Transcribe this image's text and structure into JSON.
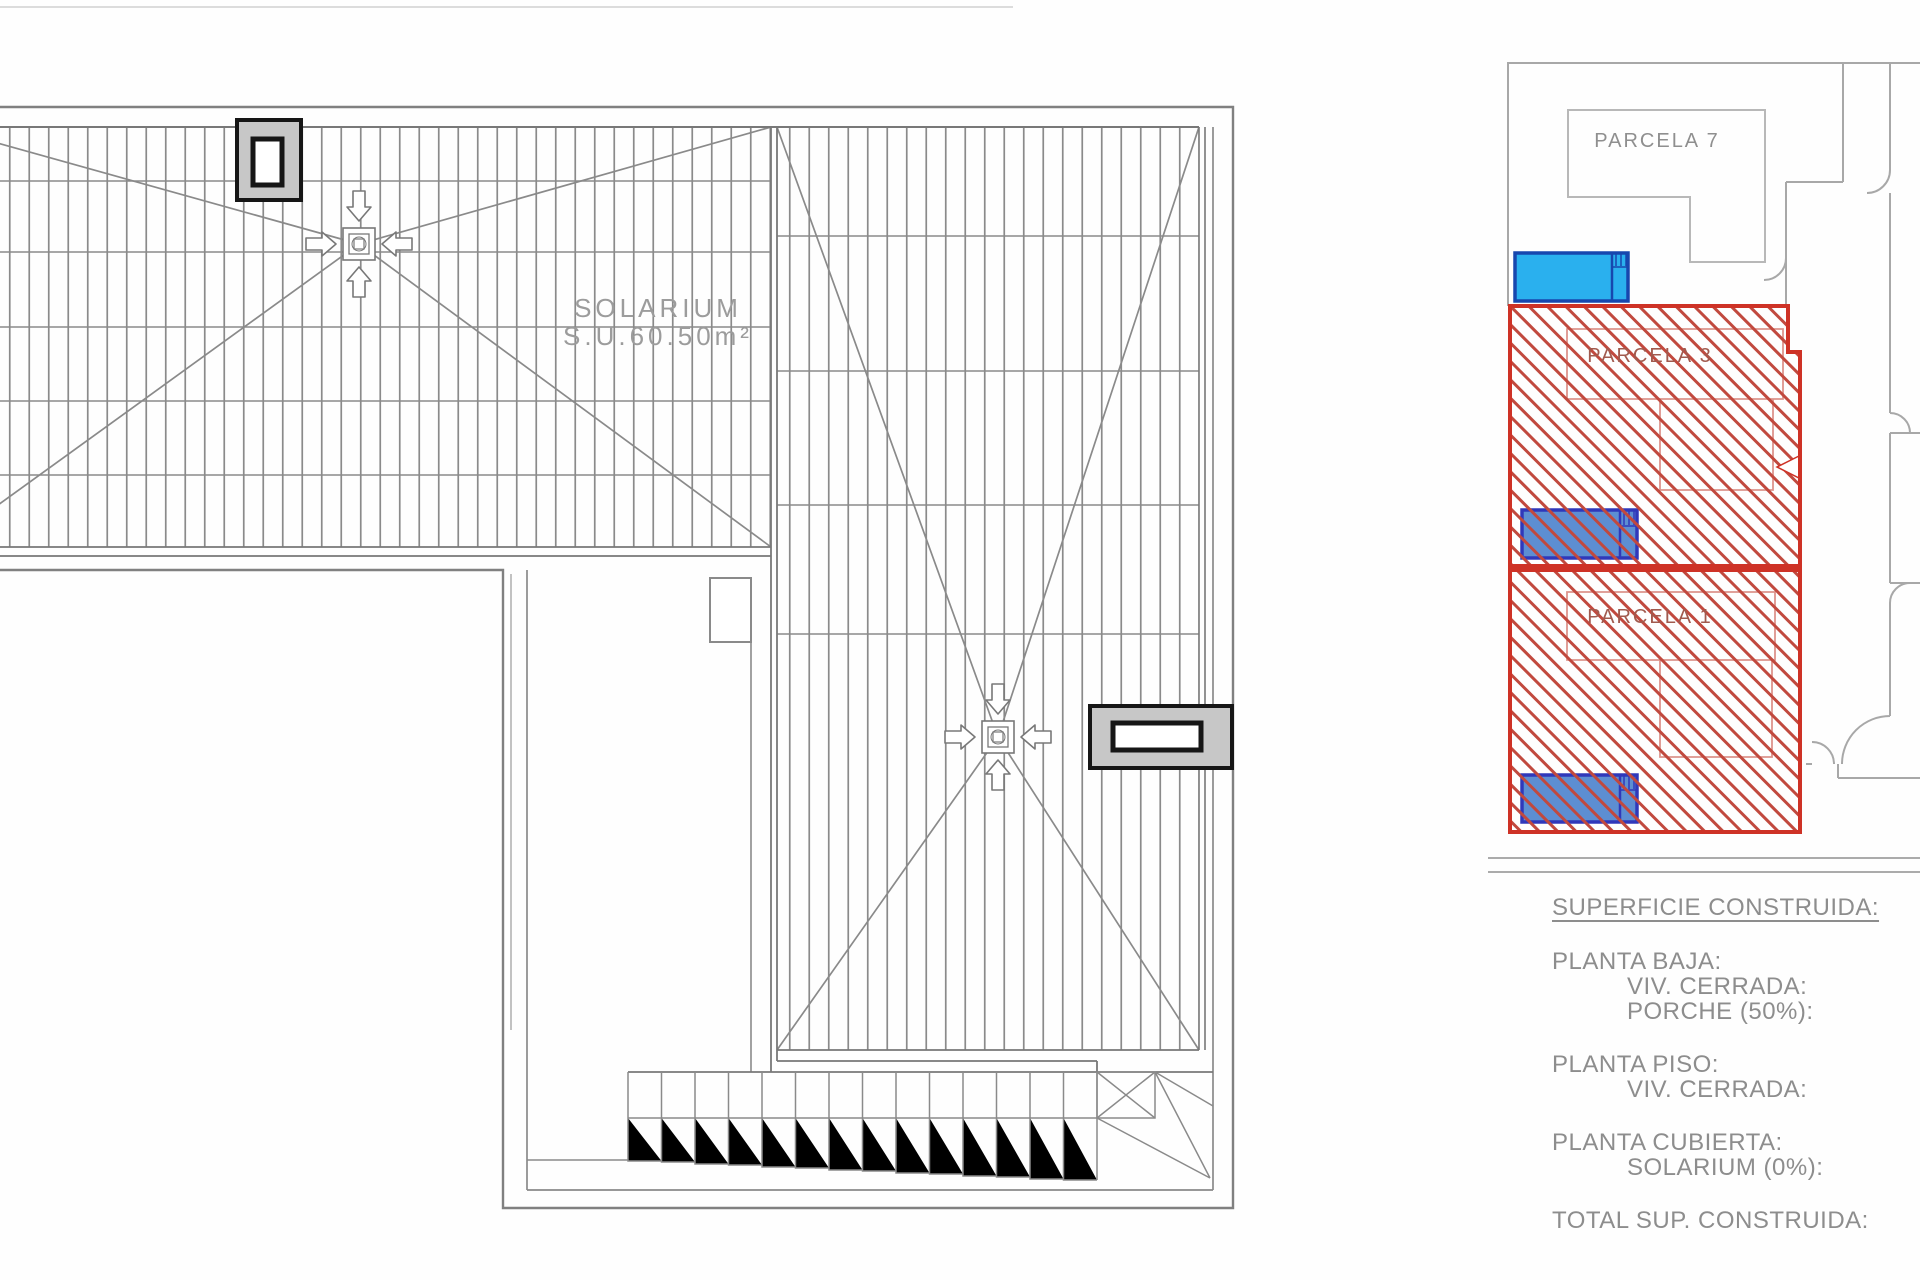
{
  "main_plan": {
    "solarium_label": {
      "line1": "SOLARIUM",
      "line2": "S.U.60.50m²"
    }
  },
  "site_plan": {
    "parcel_7_label": "PARCELA 7",
    "parcel_3_label": "PARCELA 3",
    "parcel_1_label": "PARCELA 1"
  },
  "legend": {
    "title": "SUPERFICIE CONSTRUIDA:",
    "sections": [
      {
        "heading": "PLANTA BAJA:",
        "items": [
          "VIV. CERRADA:",
          "PORCHE (50%):"
        ]
      },
      {
        "heading": "PLANTA PISO:",
        "items": [
          "VIV. CERRADA:"
        ]
      },
      {
        "heading": "PLANTA CUBIERTA:",
        "items": [
          "SOLARIUM (0%):"
        ]
      }
    ],
    "total": "TOTAL SUP. CONSTRUIDA:"
  },
  "colors": {
    "parcel_border_red": "#ce3226",
    "parcel_hatch_red": "#c1493e",
    "pool_light_blue": "#2ab0ee",
    "pool_steel_blue": "#5d8ed2",
    "pool_border_navy": "#1747ae",
    "plan_line_gray": "#787878",
    "label_gray": "#8d8d8d"
  }
}
